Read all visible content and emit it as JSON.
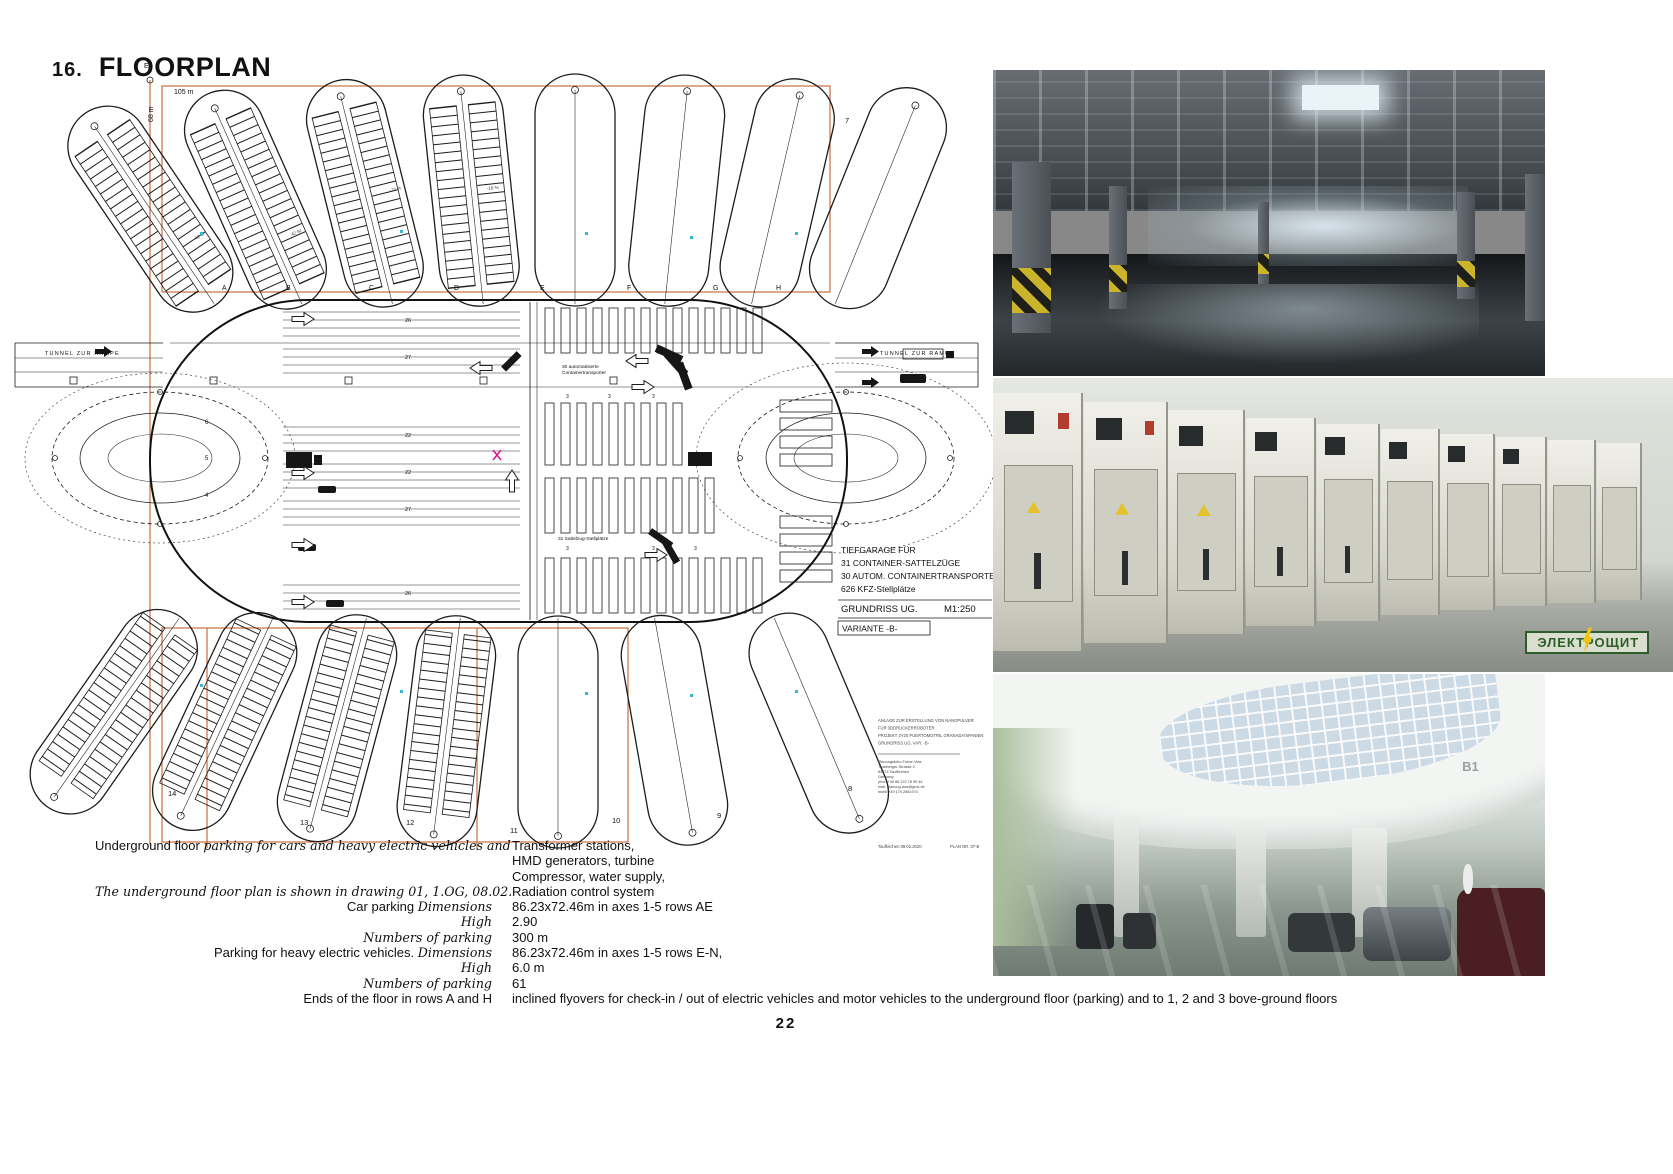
{
  "page": {
    "number": "22"
  },
  "header": {
    "number": "16.",
    "title": "FLOORPLAN"
  },
  "plan": {
    "dims": {
      "axis_letter": "E",
      "height_label": "68 m",
      "width_label": "105 m"
    },
    "tunnel_left": "TUNNEL ZUR RAMPE",
    "tunnel_right": "TUNNEL ZUR RAMPE",
    "grid_letters": [
      "A",
      "B",
      "C",
      "D",
      "E",
      "F",
      "G",
      "H"
    ],
    "top_lobe_number": "7",
    "lobe_numbers_bottom": [
      "14",
      "13",
      "12",
      "11",
      "10",
      "9",
      "8"
    ],
    "row_labels": [
      "26",
      "27",
      "22",
      "22",
      "27",
      "26"
    ],
    "left_zone_numbers": [
      "6",
      "5",
      "4"
    ],
    "slot_count_label": "3",
    "stall_label": "42 St",
    "slope_label": "-18 %",
    "center_notes": {
      "transporter_1": "30 automatisierte",
      "transporter_2": "Containertransporter",
      "sattelzug": "31 Sattelzug-Stellplätze"
    },
    "title_block": {
      "line1": "TIEFGARAGE FÜR",
      "line2": "31 CONTAINER-SATTELZÜGE",
      "line3": "30 AUTOM. CONTAINERTRANSPORTER",
      "line4": "626 KFZ-Stellplätze",
      "drawing": "GRUNDRISS  UG.",
      "scale": "M1:250",
      "variant": "VARIANTE  -B-"
    },
    "stamp": {
      "l1": "ANLAGE ZUR ERSTELLUNG VON NANOPULVER",
      "l2": "FÜR 3DDRUCKERROBOTER",
      "l3": "PROJEKT 3Y20 PUERTOMOTRIL GRANADA/SPANIEN",
      "l4": "GRUNDRISS UG. VAR. -B-",
      "firm1": "Planungsbüro Furrer-Vias",
      "firm2": "Trostberger-Strasse 2",
      "firm3": "84574 Taufkirchen",
      "firm4": "Germany",
      "firm5": "phon +49 86 222 78 59 46",
      "firm6": "mail: planung.vias@gmx.de",
      "firm7": "mobil +49 170 2881974",
      "date": "Taufkirchen 09.02.2020",
      "plan_no": "PLAN NR. 07-B"
    }
  },
  "photos": {
    "switchgear_badge": "ЭЛЕКТРОЩИТ",
    "bottom_label": "B1"
  },
  "specs": {
    "rows": [
      {
        "l1": "Underground floor ",
        "l2": "parking for cars and heavy electric vehicles and",
        "r": "Transformer stations,"
      },
      {
        "l1": "",
        "l2": "",
        "r": "HMD generators, turbine"
      },
      {
        "l1": "",
        "l2": "",
        "r": "Compressor, water supply,"
      },
      {
        "l1": "",
        "l2": "The underground floor plan is shown in drawing 01, 1.OG, 08.02.",
        "r": "Radiation control system"
      },
      {
        "l1": "Car parking ",
        "l2": "Dimensions",
        "r": "86.23x72.46m in axes 1-5 rows AE"
      },
      {
        "l1": "",
        "l2": "High",
        "r": "2.90"
      },
      {
        "l1": "",
        "l2": "Numbers of parking",
        "r": "300 m"
      },
      {
        "l1": "Parking for heavy electric vehicles. ",
        "l2": "Dimensions",
        "r": "86.23x72.46m in axes 1-5 rows E-N,"
      },
      {
        "l1": "",
        "l2": "High",
        "r": "6.0 m"
      },
      {
        "l1": "",
        "l2": "Numbers of parking",
        "r": "61"
      },
      {
        "l1": "Ends of the floor in rows A and H",
        "l2": "",
        "r": "inclined flyovers for check-in / out of electric vehicles and motor vehicles to the underground floor (parking) and to 1, 2 and 3 bove-ground floors"
      }
    ]
  },
  "colors": {
    "accent_orange": "#c4602f",
    "hazard_yellow": "#c9b42b",
    "badge_green": "#2c5e2a",
    "mark_cyan": "#35b8d8",
    "mark_magenta": "#d6158e"
  }
}
